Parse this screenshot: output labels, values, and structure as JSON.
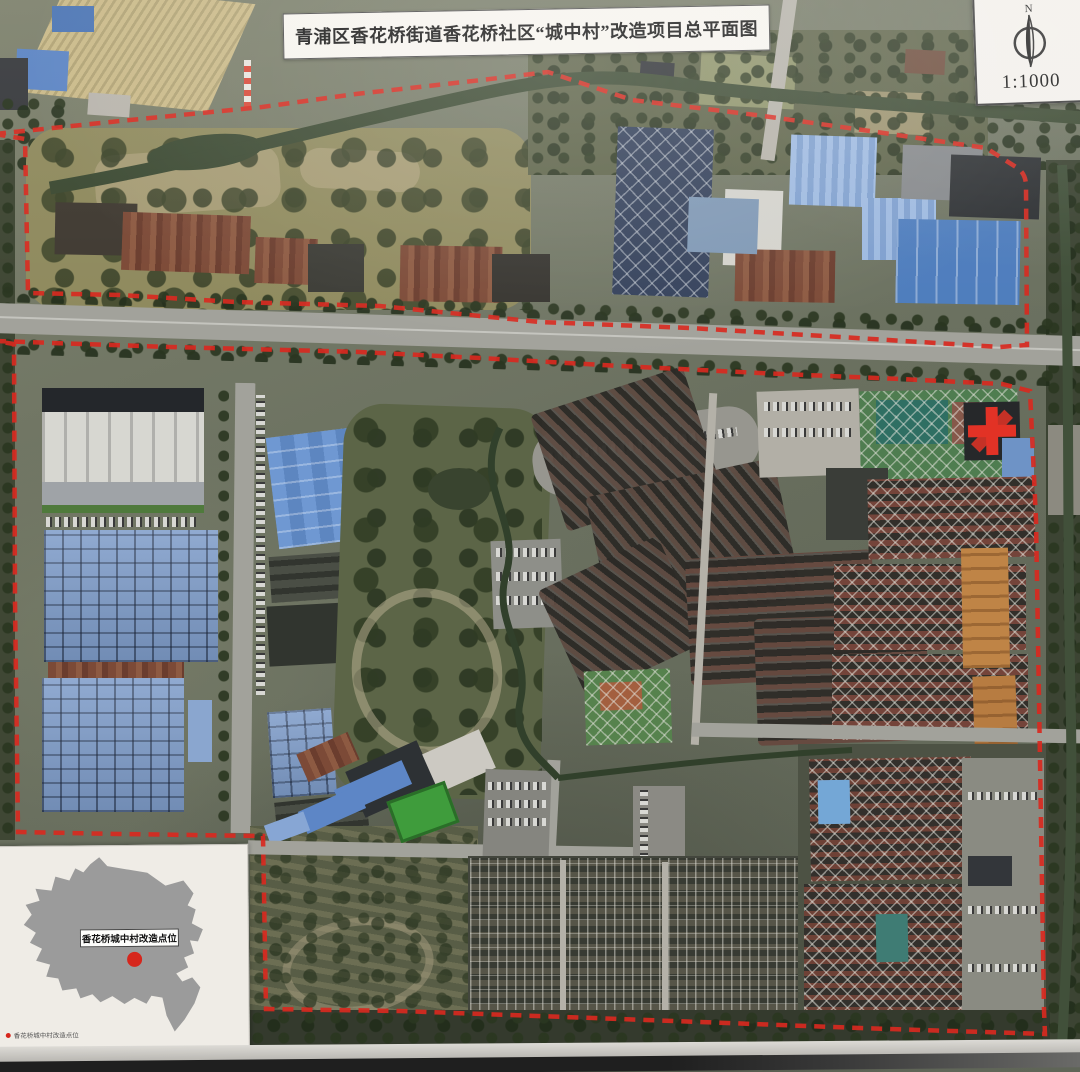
{
  "header": {
    "title": "青浦区香花桥街道香花桥社区“城中村”改造项目总平面图"
  },
  "scale_box": {
    "north_label": "N",
    "scale_label": "1:1000"
  },
  "inset_map": {
    "callout_label": "香花桥城中村改造点位",
    "legend_label": "香花桥城中村改造点位"
  },
  "colors": {
    "boundary_red": "#d8291f",
    "marker_red": "#d6261c",
    "silhouette_gray": "#9b9b9b",
    "cross_red": "#e23226",
    "river_green": "#3c4a33"
  }
}
